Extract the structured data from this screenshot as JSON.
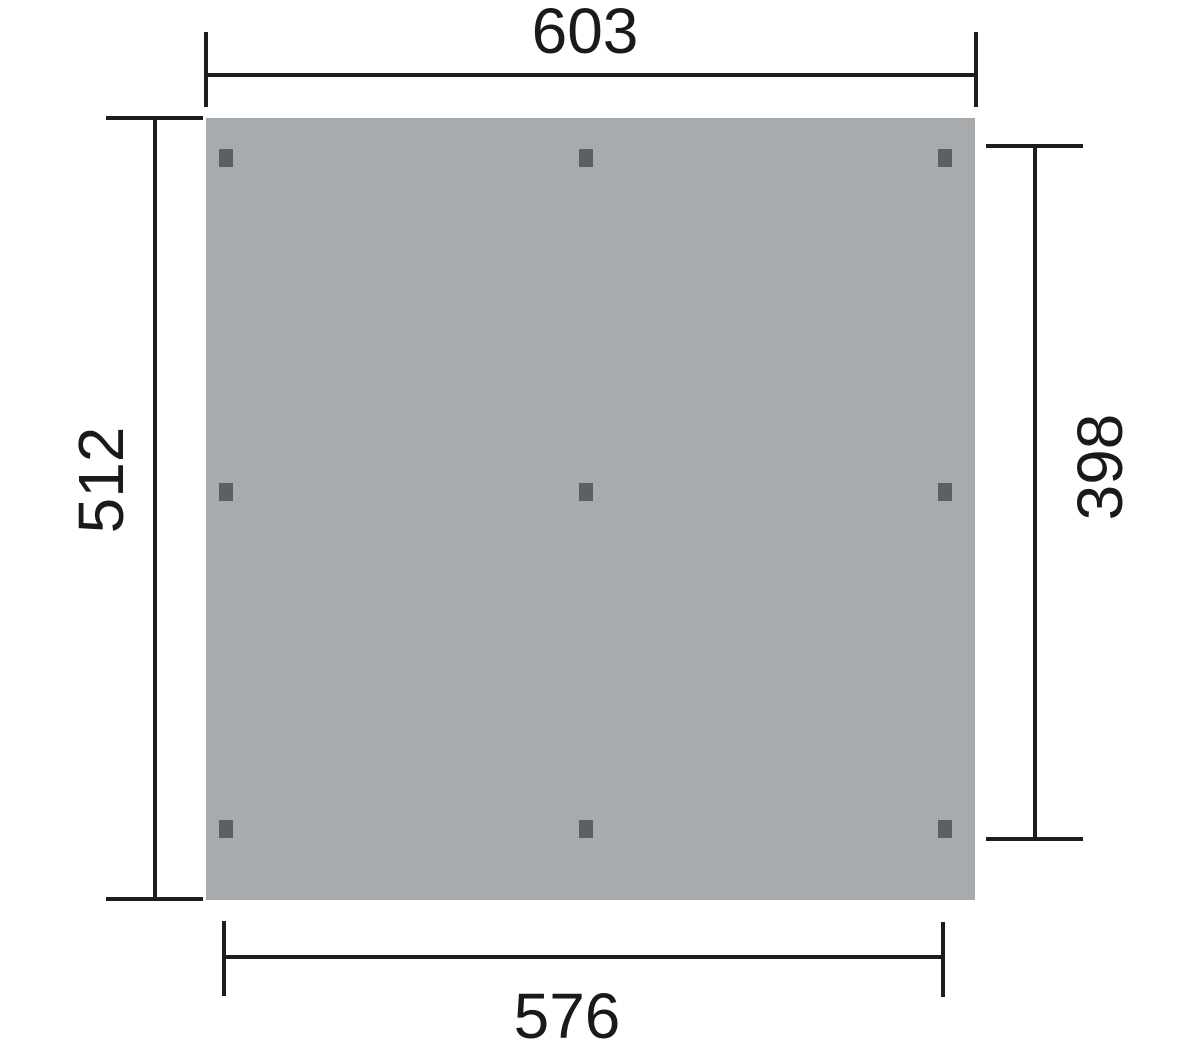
{
  "drawing": {
    "type": "dimensioned-plan-view",
    "dimensions": {
      "top": {
        "value": "603",
        "orientation": "horizontal",
        "position": "top"
      },
      "left": {
        "value": "512",
        "orientation": "vertical",
        "position": "left"
      },
      "right": {
        "value": "398",
        "orientation": "vertical",
        "position": "right"
      },
      "bottom": {
        "value": "576",
        "orientation": "horizontal",
        "position": "bottom"
      }
    },
    "surface": {
      "post_rows": 3,
      "post_cols": 3,
      "post_count": 9
    },
    "colors": {
      "background": "#ffffff",
      "surface": "#a7abae",
      "post": "#5c6064",
      "line": "#1d1d1b",
      "text": "#1a1a1a"
    }
  }
}
